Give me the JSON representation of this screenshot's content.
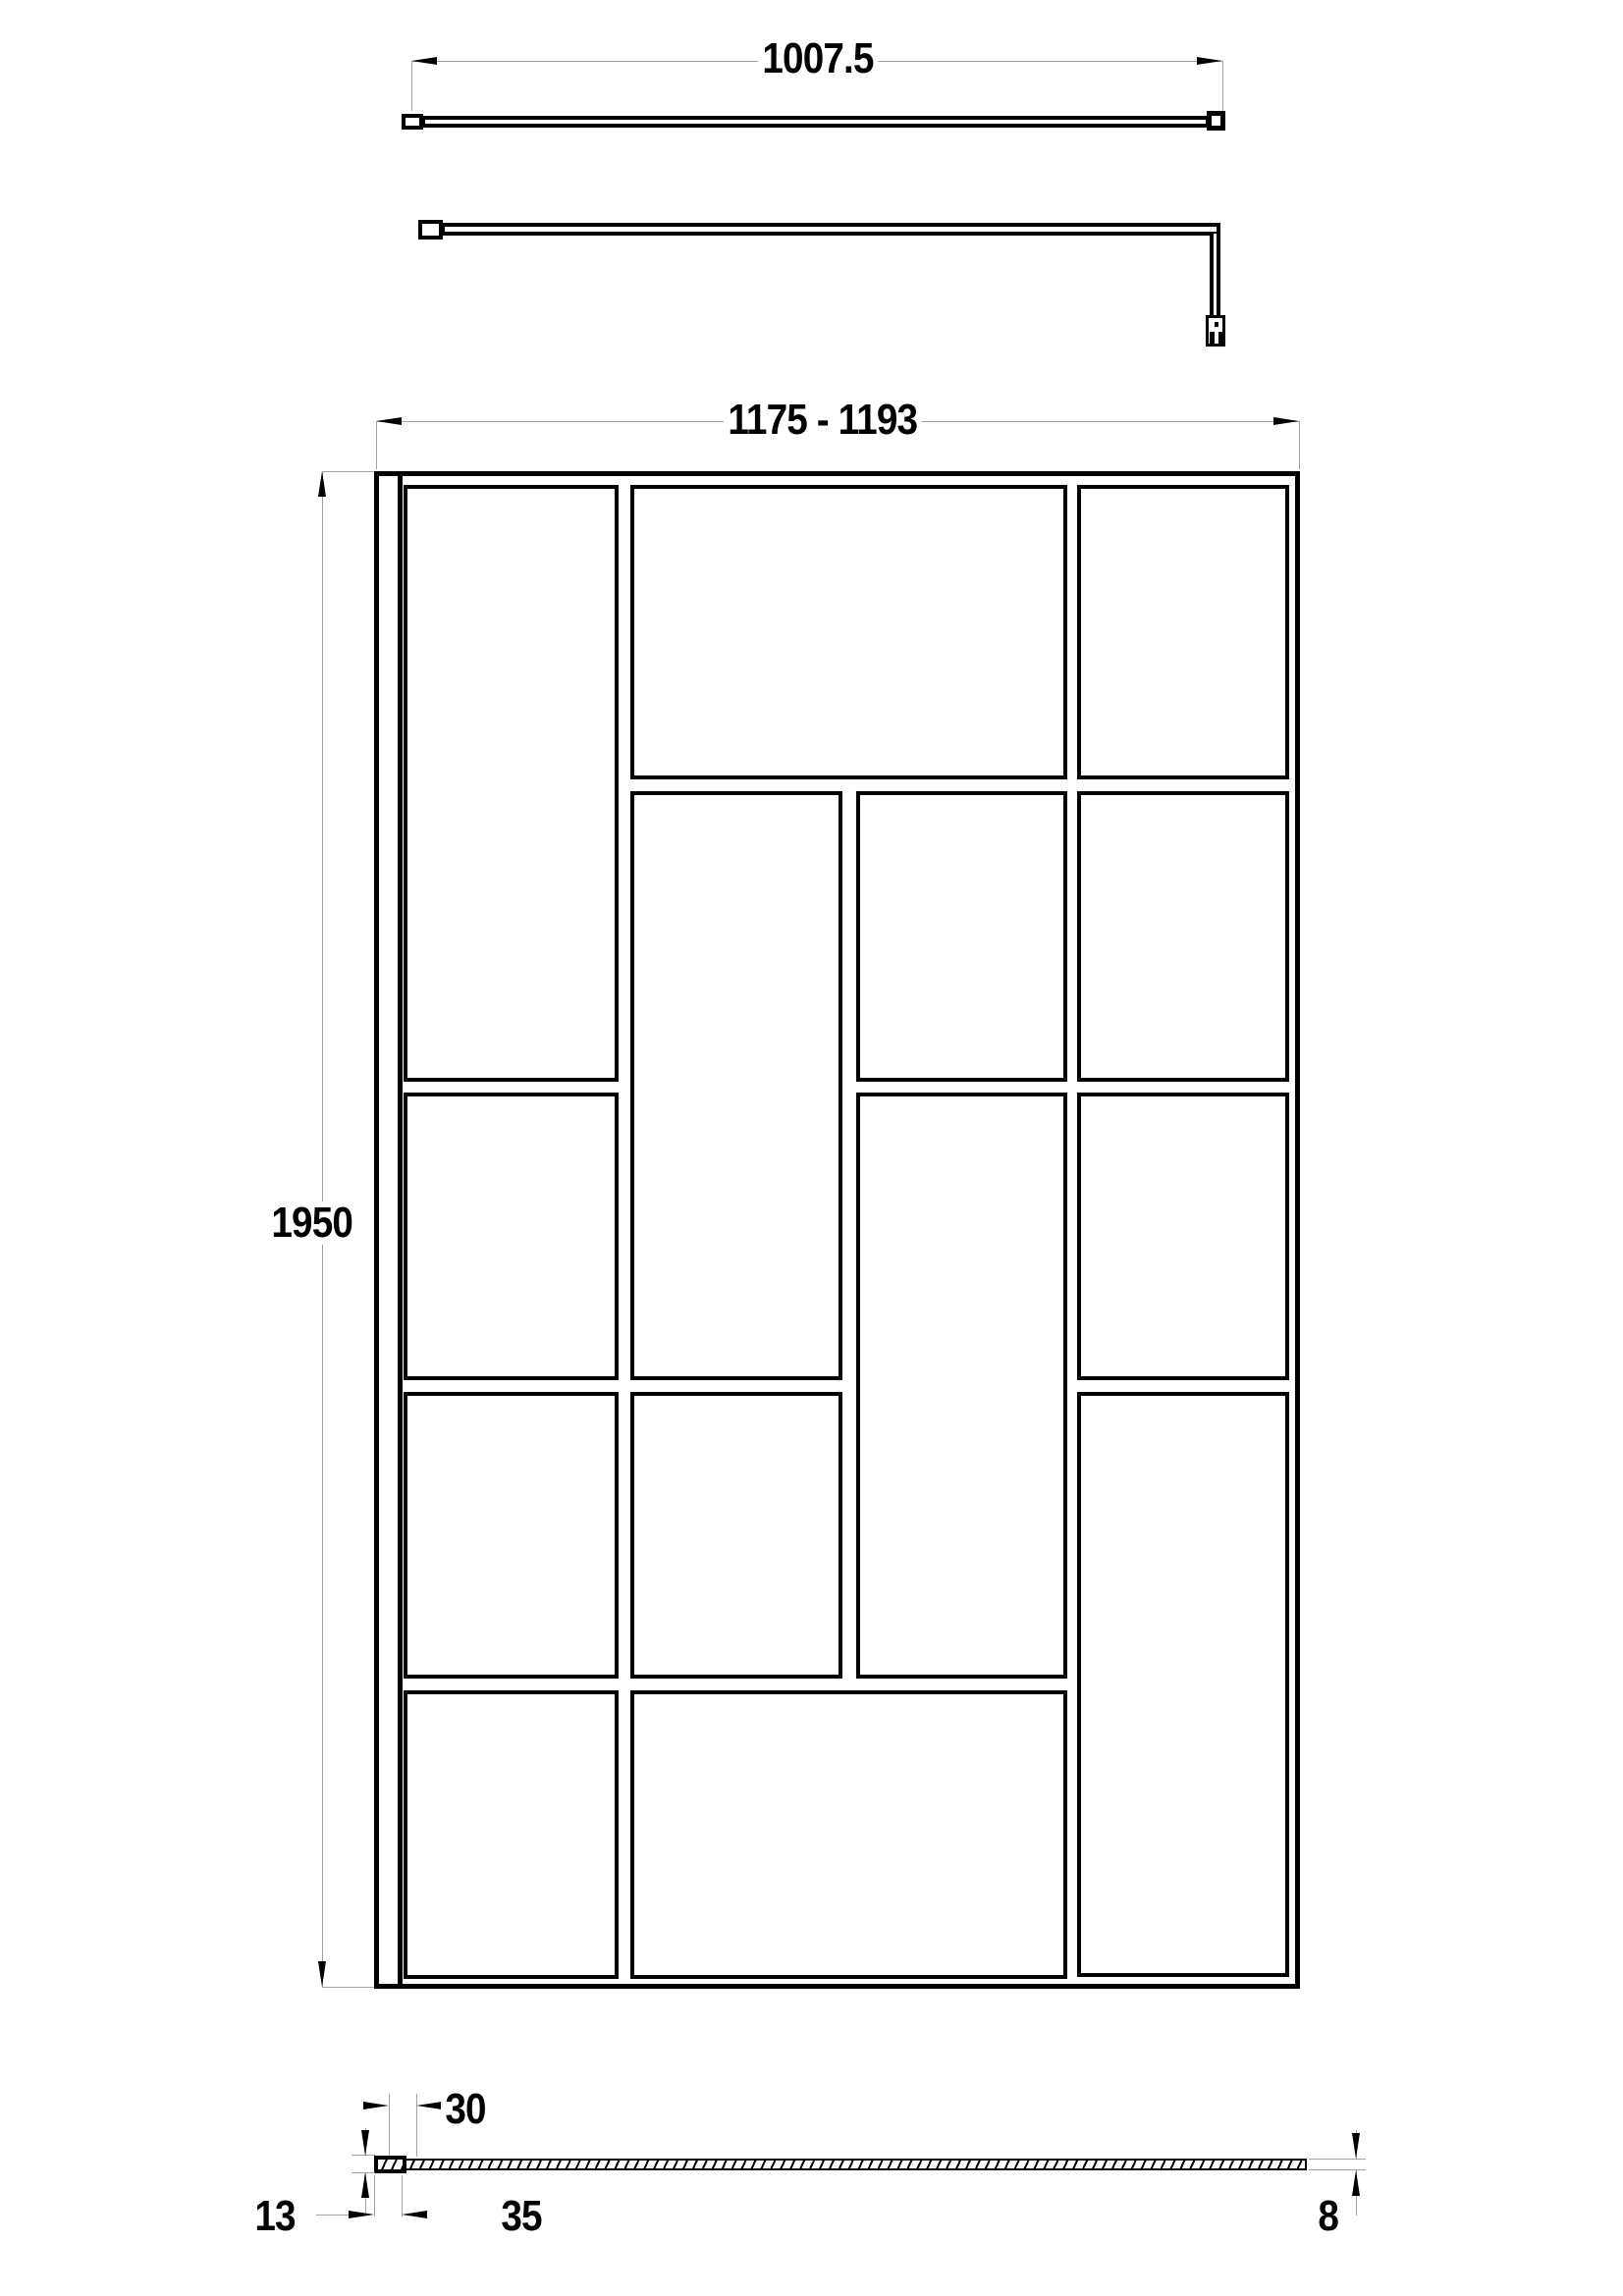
{
  "title": "Walk-in shower screen technical drawing",
  "labels": {
    "bar_length": "1007.5",
    "screen_width": "1175 - 1193",
    "screen_height": "1950",
    "profile_width": "30",
    "profile_height": "13",
    "profile_base": "35",
    "glass_thickness": "8"
  },
  "colors": {
    "line": "#000000",
    "dim_line": "#a3a3a3",
    "background": "#ffffff"
  }
}
